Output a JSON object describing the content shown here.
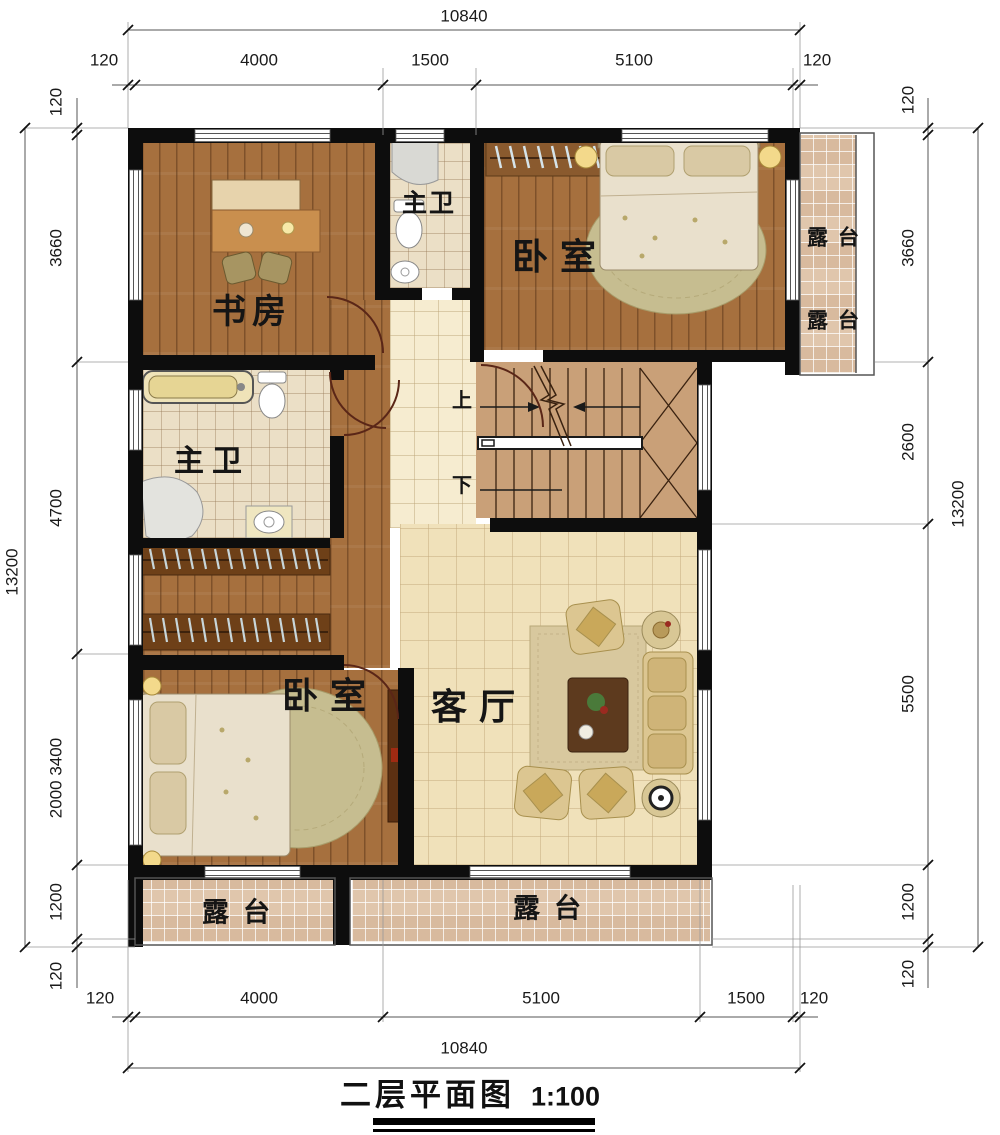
{
  "title": {
    "name": "二层平面图",
    "scale": "1:100"
  },
  "rooms": {
    "study": "书房",
    "bath_top": "主卫",
    "bedroom_top": "卧室",
    "bath_left": "主卫",
    "bedroom_bottom": "卧室",
    "living": "客厅",
    "terrace": "露台",
    "stair_up": "上",
    "stair_down": "下"
  },
  "dimensions": {
    "top": {
      "overall": "10840",
      "segments": [
        "120",
        "4000",
        "1500",
        "5100",
        "120"
      ]
    },
    "bottom": {
      "overall": "10840",
      "segments": [
        "120",
        "4000",
        "5100",
        "1500",
        "120"
      ]
    },
    "left": {
      "overall": "13200",
      "segments": [
        "120",
        "3660",
        "4700",
        "2000 3400",
        "1200",
        "120"
      ]
    },
    "right": {
      "overall": "13200",
      "segments": [
        "120",
        "3660",
        "2600",
        "5500",
        "1200",
        "120"
      ]
    }
  },
  "colors": {
    "wall": "#0d0d0d",
    "wood_floor": "#a6703e",
    "bath_tile": "#ebdfc6",
    "living_tile": "#f0e1ba",
    "terrace_tile": "#e0c6ac",
    "stair": "#c9a078",
    "door_arc": "#5a2617"
  }
}
